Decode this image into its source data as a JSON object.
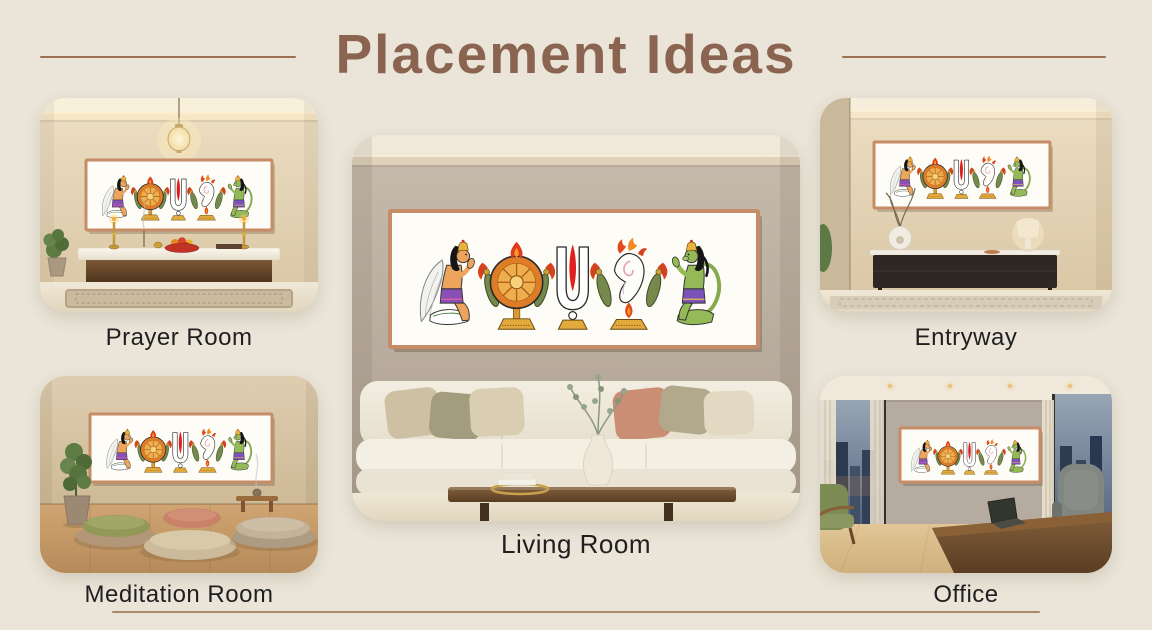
{
  "page": {
    "title": "Placement Ideas"
  },
  "cards": [
    {
      "id": "prayer-room",
      "label": "Prayer Room"
    },
    {
      "id": "meditation-room",
      "label": "Meditation Room"
    },
    {
      "id": "living-room",
      "label": "Living Room"
    },
    {
      "id": "entryway",
      "label": "Entryway"
    },
    {
      "id": "office",
      "label": "Office"
    }
  ],
  "artwork": {
    "description": "Framed Vaishnava symbols wall art print",
    "elements": [
      "garuda",
      "sudarshana-chakra",
      "vishnu-namam-tilak",
      "shankha-conch",
      "hanuman"
    ]
  },
  "colors": {
    "background": "#EAE5D8",
    "title_text": "#8A6450",
    "title_rule": "#9C7050",
    "label_text": "#1F1F1F",
    "bottom_divider": "#A9886C",
    "frame": "#C68B67"
  }
}
